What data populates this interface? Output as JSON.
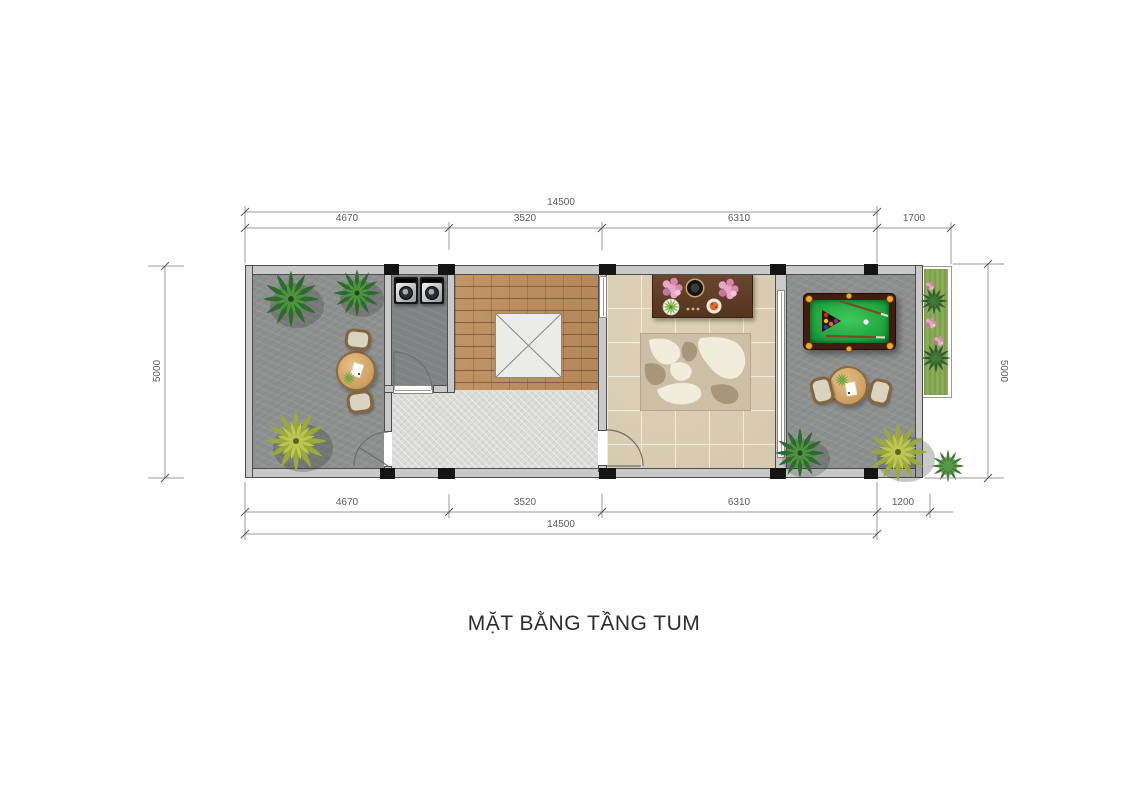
{
  "title": "MẶT BẰNG TẦNG TUM",
  "dimensions": {
    "top": {
      "overall": "14500",
      "segments": [
        "4670",
        "3520",
        "6310",
        "1700"
      ]
    },
    "bottom": {
      "overall": "14500",
      "segments": [
        "4670",
        "3520",
        "6310",
        "1200"
      ]
    },
    "left": "5000",
    "right": "5000"
  },
  "colors": {
    "wall_fill": "#c9c9c9",
    "column": "#141414",
    "terrace_floor": "#8e9090",
    "laundry_floor": "#808384",
    "wood_floor": "#b3875a",
    "hallway_floor": "#dcdcda",
    "room_floor": "#d6c9ae",
    "pool_felt": "#1fa23e",
    "pool_rail": "#441b10",
    "planter_grass": "#8aab57",
    "plant_green": "#2e6b2e",
    "plant_yellow": "#9aa93c",
    "dim_text": "#5e5e5e",
    "title_color": "#2d2d2d"
  }
}
